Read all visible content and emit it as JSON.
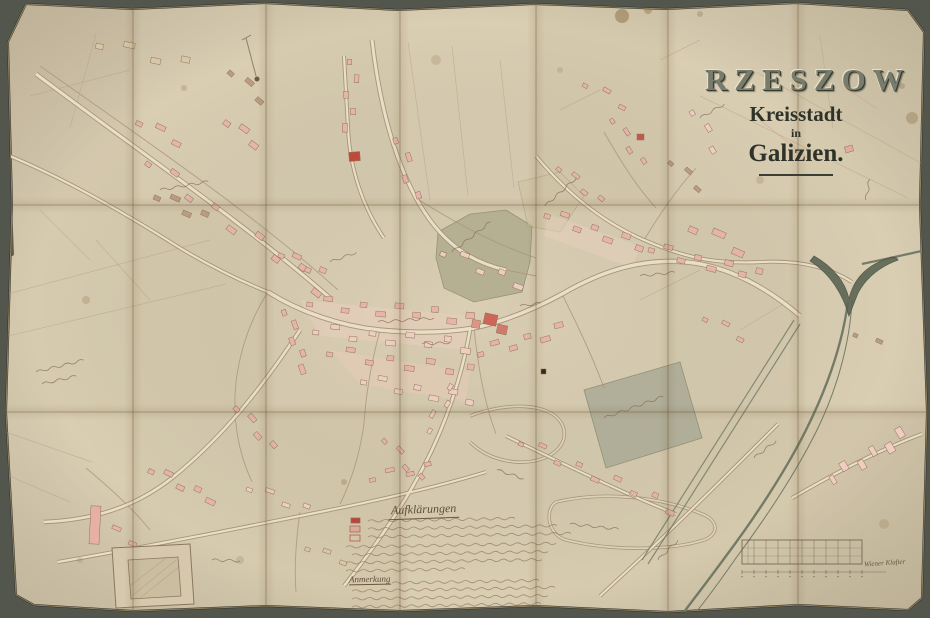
{
  "window": {
    "width": 930,
    "height": 618
  },
  "colors": {
    "backdrop": "#53564c",
    "paper": "#d9cdb2",
    "paper_edge": "#b9a67f",
    "road_casing": "#9f8c72",
    "road_fill": "#e9dfc6",
    "minor_road": "#a7937a",
    "river": "#68725f",
    "river_fork": "#5c6553",
    "building_outline": "#8f7260",
    "handwriting": "#87705f",
    "legend_ink": "#93795f",
    "palette": {
      "pink": "#e7b3a8",
      "lightpink": "#f0cfc2",
      "red": "#c4574a",
      "brown": "#b99a7d",
      "tan": "#d8c8a8"
    }
  },
  "title": {
    "city": "RZESZOW",
    "subtitle1": "Kreisstadt",
    "subtitle2": "in",
    "region": "Galizien."
  },
  "legend": {
    "title": "Aufklärungen",
    "note_title": "Anmerkung",
    "swatches": [
      {
        "x": 351,
        "y": 518,
        "w": 9,
        "h": 5,
        "c": "#b8473a",
        "filled": true
      },
      {
        "x": 350,
        "y": 526,
        "w": 10,
        "h": 6,
        "c": "#e2a79b",
        "filled": true
      },
      {
        "x": 350,
        "y": 535,
        "w": 10,
        "h": 6,
        "c": "#b8473a",
        "filled": false
      }
    ],
    "lines": [
      [
        368,
        521,
        150
      ],
      [
        368,
        529,
        190
      ],
      [
        368,
        537,
        202
      ],
      [
        346,
        547,
        208
      ],
      [
        352,
        555,
        196
      ],
      [
        346,
        563,
        198
      ],
      [
        346,
        571,
        122
      ]
    ],
    "note_lines": [
      [
        392,
        583,
        148
      ],
      [
        352,
        591,
        200
      ],
      [
        352,
        599,
        196
      ],
      [
        352,
        607,
        188
      ],
      [
        360,
        613,
        118
      ]
    ]
  },
  "scale_bar": {
    "x": 742,
    "y": 540,
    "width": 120,
    "height": 24,
    "cols": 10,
    "label": "Wiener Klafter"
  },
  "folds": {
    "vertical": [
      133,
      266,
      400,
      536,
      668,
      798
    ],
    "horizontal": [
      205,
      412
    ]
  },
  "paper_outline": [
    [
      26,
      4
    ],
    [
      132,
      9
    ],
    [
      264,
      3
    ],
    [
      398,
      10
    ],
    [
      534,
      4
    ],
    [
      666,
      9
    ],
    [
      796,
      3
    ],
    [
      908,
      10
    ],
    [
      924,
      32
    ],
    [
      920,
      205
    ],
    [
      927,
      412
    ],
    [
      922,
      598
    ],
    [
      908,
      610
    ],
    [
      798,
      605
    ],
    [
      668,
      612
    ],
    [
      536,
      606
    ],
    [
      400,
      611
    ],
    [
      266,
      606
    ],
    [
      134,
      611
    ],
    [
      34,
      605
    ],
    [
      16,
      595
    ],
    [
      6,
      412
    ],
    [
      12,
      205
    ],
    [
      8,
      42
    ]
  ],
  "panel_tints": [
    [
      0.04,
      0,
      0.02,
      0,
      0.03,
      0,
      0.02
    ],
    [
      0.02,
      0.03,
      0,
      0.02,
      0,
      0.02,
      0
    ],
    [
      0,
      0.02,
      0.03,
      0,
      0.02,
      0.03,
      0.05
    ]
  ],
  "map": {
    "areas": [
      {
        "pts": "438,232 470,214 506,210 532,226 530,262 522,292 474,302 444,288 436,258",
        "f": "#b1ac8e",
        "o": 0.85,
        "s": "#8d8a70"
      },
      {
        "pts": "584,390 680,362 702,438 606,468",
        "f": "#a9a995",
        "o": 0.8,
        "s": "#84836c"
      },
      {
        "pts": "518,182 560,172 584,196 560,232 528,226",
        "f": "#cfc3a2",
        "o": 0.55,
        "s": "#a89a7c"
      }
    ],
    "block_washes": [
      {
        "pts": "300,300 470,316 466,350 320,336",
        "f": "#eccfbe",
        "o": 0.5
      },
      {
        "pts": "330,350 470,372 466,402 360,384",
        "f": "#eac9b8",
        "o": 0.45
      },
      {
        "pts": "548,214 640,246 632,268 544,236",
        "f": "#ecd2c2",
        "o": 0.4
      }
    ],
    "field_lines": [
      [
        756,
        72,
        930,
        168
      ],
      [
        700,
        96,
        908,
        198
      ],
      [
        820,
        36,
        833,
        128
      ],
      [
        408,
        42,
        430,
        200
      ],
      [
        452,
        46,
        468,
        196
      ],
      [
        500,
        60,
        514,
        188
      ],
      [
        0,
        296,
        210,
        240
      ],
      [
        0,
        338,
        226,
        284
      ],
      [
        30,
        96,
        130,
        70
      ],
      [
        96,
        34,
        70,
        128
      ],
      [
        0,
        430,
        92,
        462
      ],
      [
        0,
        472,
        70,
        502
      ],
      [
        560,
        110,
        600,
        90
      ],
      [
        660,
        60,
        700,
        40
      ],
      [
        740,
        330,
        790,
        300
      ],
      [
        640,
        300,
        700,
        270
      ],
      [
        96,
        240,
        150,
        300
      ],
      [
        40,
        210,
        90,
        260
      ]
    ],
    "pink_lines": [
      [
        846,
        88,
        876,
        108
      ],
      [
        760,
        120,
        810,
        160
      ]
    ],
    "roads": [
      {
        "d": "M36,74 C140,152 248,226 330,298",
        "w": 3
      },
      {
        "d": "M268,292 C300,312 340,326 380,330 C420,334 450,332 474,328",
        "w": 3.5
      },
      {
        "d": "M474,328 C510,320 540,306 562,294 C600,272 640,258 686,262 C730,266 770,290 800,316",
        "w": 3.5
      },
      {
        "d": "M372,40 C378,92 390,150 416,198 C440,242 470,262 506,270",
        "w": 3
      },
      {
        "d": "M344,56 L348,128 C350,168 362,206 384,238",
        "w": 2.2
      },
      {
        "d": "M536,156 C566,192 602,222 644,240 C690,260 720,264 762,262 C800,260 830,268 852,282",
        "w": 2.2
      },
      {
        "d": "M470,330 C462,376 446,424 424,466 C402,508 374,548 344,586",
        "w": 2.6
      },
      {
        "d": "M300,330 C262,388 222,438 172,478 C134,508 92,520 44,522",
        "w": 2.6
      },
      {
        "d": "M58,562 C150,546 240,528 320,512 C390,498 440,486 486,472",
        "w": 2.2
      },
      {
        "d": "M506,436 C560,462 620,492 676,514",
        "w": 2
      },
      {
        "d": "M792,498 C840,470 884,448 922,434",
        "w": 2.2
      },
      {
        "d": "M778,424 C732,470 680,522 628,570 L600,596",
        "w": 2
      },
      {
        "d": "M0,152 C60,176 120,210 180,248 C220,272 248,284 268,292",
        "w": 2.2
      }
    ],
    "minor_roads": [
      "M416,198 C460,226 500,246 536,258",
      "M268,292 C250,320 240,350 236,382",
      "M236,382 C232,420 238,452 252,482",
      "M380,330 C372,360 366,392 364,424",
      "M364,424 C360,452 352,480 340,504",
      "M474,328 C478,366 484,402 496,434",
      "M562,294 C580,330 594,360 604,388",
      "M644,240 C660,214 676,190 696,168",
      "M604,132 C620,160 636,186 656,208",
      "M86,468 C110,488 134,510 150,530",
      "M300,512 C296,540 294,566 296,592",
      "M40,66 C148,142 256,216 338,290",
      "M140,546 C146,566 150,586 152,604",
      "M506,270 C516,272 526,274 536,276"
    ],
    "rivers": [
      {
        "d": "M926,250 C900,256 880,260 862,264",
        "w": 2.2
      },
      {
        "d": "M848,302 C842,346 826,390 806,430 C786,470 756,516 726,556 C710,578 696,596 684,612",
        "w": 2.4
      },
      {
        "d": "M852,300 C850,344 836,392 816,432 C796,472 766,518 736,558 C722,578 708,598 696,612",
        "w": 1
      }
    ],
    "fork": "M814,256 C833,267 845,281 849,299 C853,281 864,267 886,259 C893,256 897,257 898,260 C879,267 866,278 858,293 L849,316 C843,295 831,274 810,261 Z",
    "channels": [
      "M794,320 L642,560",
      "M800,324 L648,564"
    ],
    "meanders": [
      "M470,416 C506,402 550,402 562,424 C572,446 548,464 516,462 C492,460 478,450 470,442",
      "M556,502 C606,490 664,498 702,514 C718,520 720,534 704,540 C666,552 606,550 566,540 C548,535 544,510 556,502"
    ],
    "building_rows": [
      {
        "x1": 100,
        "y1": 44,
        "x2": 185,
        "y2": 62,
        "n": 4,
        "w": 10,
        "h": 7,
        "c": "tan",
        "s": 5
      },
      {
        "x1": 232,
        "y1": 72,
        "x2": 262,
        "y2": 98,
        "n": 3,
        "w": 8,
        "h": 6,
        "c": "brown",
        "s": 4
      },
      {
        "x1": 140,
        "y1": 122,
        "x2": 178,
        "y2": 140,
        "n": 3,
        "w": 9,
        "h": 6,
        "c": "pink",
        "s": 4
      },
      {
        "x1": 158,
        "y1": 196,
        "x2": 204,
        "y2": 216,
        "n": 4,
        "w": 9,
        "h": 6,
        "c": "brown",
        "s": 5
      },
      {
        "x1": 228,
        "y1": 122,
        "x2": 256,
        "y2": 142,
        "n": 3,
        "w": 9,
        "h": 7,
        "c": "pink",
        "s": 4
      },
      {
        "x1": 282,
        "y1": 254,
        "x2": 322,
        "y2": 272,
        "n": 4,
        "w": 8,
        "h": 6,
        "c": "pink",
        "s": 4
      },
      {
        "x1": 150,
        "y1": 162,
        "x2": 320,
        "y2": 288,
        "n": 9,
        "w": 8,
        "h": 6,
        "c": "pink",
        "s": 6
      },
      {
        "x1": 352,
        "y1": 62,
        "x2": 350,
        "y2": 128,
        "n": 5,
        "w": 7,
        "h": 6,
        "c": "pink",
        "s": 5
      },
      {
        "x1": 398,
        "y1": 140,
        "x2": 416,
        "y2": 196,
        "n": 4,
        "w": 8,
        "h": 6,
        "c": "pink",
        "s": 5
      },
      {
        "x1": 310,
        "y1": 302,
        "x2": 470,
        "y2": 318,
        "n": 10,
        "w": 8,
        "h": 6,
        "c": "pink",
        "s": 5
      },
      {
        "x1": 316,
        "y1": 330,
        "x2": 466,
        "y2": 346,
        "n": 9,
        "w": 8,
        "h": 6,
        "c": "lightpink",
        "s": 5
      },
      {
        "x1": 330,
        "y1": 352,
        "x2": 470,
        "y2": 372,
        "n": 8,
        "w": 8,
        "h": 6,
        "c": "pink",
        "s": 5
      },
      {
        "x1": 286,
        "y1": 312,
        "x2": 306,
        "y2": 368,
        "n": 5,
        "w": 8,
        "h": 6,
        "c": "pink",
        "s": 4
      },
      {
        "x1": 364,
        "y1": 380,
        "x2": 470,
        "y2": 400,
        "n": 7,
        "w": 8,
        "h": 6,
        "c": "lightpink",
        "s": 5
      },
      {
        "x1": 480,
        "y1": 352,
        "x2": 560,
        "y2": 330,
        "n": 6,
        "w": 8,
        "h": 6,
        "c": "pink",
        "s": 5
      },
      {
        "x1": 548,
        "y1": 214,
        "x2": 640,
        "y2": 246,
        "n": 7,
        "w": 8,
        "h": 6,
        "c": "pink",
        "s": 5
      },
      {
        "x1": 652,
        "y1": 248,
        "x2": 758,
        "y2": 276,
        "n": 8,
        "w": 8,
        "h": 6,
        "c": "pink",
        "s": 5
      },
      {
        "x1": 560,
        "y1": 168,
        "x2": 600,
        "y2": 200,
        "n": 4,
        "w": 7,
        "h": 5,
        "c": "pink",
        "s": 4
      },
      {
        "x1": 614,
        "y1": 120,
        "x2": 642,
        "y2": 162,
        "n": 4,
        "w": 7,
        "h": 5,
        "c": "pink",
        "s": 4
      },
      {
        "x1": 672,
        "y1": 162,
        "x2": 700,
        "y2": 186,
        "n": 3,
        "w": 7,
        "h": 5,
        "c": "brown",
        "s": 4
      },
      {
        "x1": 832,
        "y1": 478,
        "x2": 902,
        "y2": 436,
        "n": 6,
        "w": 6,
        "h": 12,
        "c": "lightpink",
        "s": 4
      },
      {
        "x1": 522,
        "y1": 442,
        "x2": 672,
        "y2": 508,
        "n": 9,
        "w": 7,
        "h": 5,
        "c": "pink",
        "s": 5
      },
      {
        "x1": 428,
        "y1": 430,
        "x2": 452,
        "y2": 388,
        "n": 4,
        "w": 7,
        "h": 5,
        "c": "lightpink",
        "s": 4
      },
      {
        "x1": 386,
        "y1": 440,
        "x2": 420,
        "y2": 478,
        "n": 4,
        "w": 7,
        "h": 5,
        "c": "pink",
        "s": 4
      },
      {
        "x1": 238,
        "y1": 408,
        "x2": 272,
        "y2": 446,
        "n": 4,
        "w": 8,
        "h": 6,
        "c": "pink",
        "s": 4
      },
      {
        "x1": 152,
        "y1": 470,
        "x2": 212,
        "y2": 498,
        "n": 5,
        "w": 8,
        "h": 6,
        "c": "pink",
        "s": 4
      },
      {
        "x1": 96,
        "y1": 524,
        "x2": 134,
        "y2": 540,
        "n": 3,
        "w": 8,
        "h": 5,
        "c": "pink",
        "s": 4
      },
      {
        "x1": 250,
        "y1": 488,
        "x2": 306,
        "y2": 508,
        "n": 4,
        "w": 8,
        "h": 5,
        "c": "lightpink",
        "s": 4
      },
      {
        "x1": 372,
        "y1": 478,
        "x2": 428,
        "y2": 466,
        "n": 4,
        "w": 8,
        "h": 5,
        "c": "pink",
        "s": 4
      },
      {
        "x1": 586,
        "y1": 84,
        "x2": 624,
        "y2": 104,
        "n": 3,
        "w": 7,
        "h": 5,
        "c": "pink",
        "s": 4
      },
      {
        "x1": 706,
        "y1": 318,
        "x2": 742,
        "y2": 336,
        "n": 3,
        "w": 7,
        "h": 5,
        "c": "pink",
        "s": 4
      },
      {
        "x1": 694,
        "y1": 112,
        "x2": 716,
        "y2": 148,
        "n": 3,
        "w": 7,
        "h": 6,
        "c": "lightpink",
        "s": 4
      },
      {
        "x1": 856,
        "y1": 334,
        "x2": 878,
        "y2": 344,
        "n": 2,
        "w": 6,
        "h": 5,
        "c": "brown",
        "s": 3
      },
      {
        "x1": 694,
        "y1": 228,
        "x2": 740,
        "y2": 248,
        "n": 3,
        "w": 12,
        "h": 8,
        "c": "pink",
        "s": 5
      },
      {
        "x1": 308,
        "y1": 548,
        "x2": 344,
        "y2": 560,
        "n": 3,
        "w": 7,
        "h": 5,
        "c": "tan",
        "s": 3
      },
      {
        "x1": 444,
        "y1": 252,
        "x2": 520,
        "y2": 282,
        "n": 5,
        "w": 8,
        "h": 6,
        "c": "lightpink",
        "s": 5
      }
    ],
    "special_buildings": [
      {
        "x": 484,
        "y": 314,
        "w": 13,
        "h": 11,
        "r": 12,
        "c": "#cf6557"
      },
      {
        "x": 497,
        "y": 325,
        "w": 10,
        "h": 9,
        "r": 12,
        "c": "#d07a6c"
      },
      {
        "x": 472,
        "y": 320,
        "w": 8,
        "h": 8,
        "r": 8,
        "c": "#df9488"
      },
      {
        "x": 349,
        "y": 152,
        "w": 11,
        "h": 9,
        "r": -5,
        "c": "#bf4a3c"
      },
      {
        "x": 637,
        "y": 134,
        "w": 7,
        "h": 6,
        "r": 0,
        "c": "#c3584a"
      },
      {
        "x": 541,
        "y": 369,
        "w": 5,
        "h": 5,
        "r": 0,
        "c": "#2e2a24"
      },
      {
        "x": 845,
        "y": 146,
        "w": 8,
        "h": 6,
        "r": -15,
        "c": "#e4aa9e"
      },
      {
        "x": 90,
        "y": 506,
        "w": 10,
        "h": 38,
        "r": 3,
        "c": "#e6b0a4"
      }
    ],
    "enclosure": {
      "outer": "M112,548 L190,544 L194,604 L116,608 Z",
      "inner": "M128,560 L178,557 L181,596 L131,599 Z",
      "hatch": [
        [
          132,
          596,
          176,
          560
        ],
        [
          140,
          598,
          180,
          566
        ],
        [
          130,
          586,
          166,
          558
        ]
      ]
    },
    "avenue": {
      "line": [
        246,
        38,
        256,
        76
      ],
      "tick": [
        242,
        40,
        251,
        35
      ],
      "dot": [
        257,
        79,
        2.5
      ]
    },
    "labels": [
      [
        160,
        190,
        -10,
        46
      ],
      [
        36,
        372,
        -14,
        48
      ],
      [
        42,
        384,
        -13,
        36
      ],
      [
        452,
        252,
        -38,
        46
      ],
      [
        545,
        206,
        -42,
        40
      ],
      [
        604,
        418,
        -20,
        64
      ],
      [
        378,
        322,
        -4,
        56
      ],
      [
        497,
        470,
        18,
        30
      ],
      [
        570,
        524,
        6,
        48
      ],
      [
        754,
        458,
        -38,
        30
      ],
      [
        640,
        276,
        -6,
        34
      ],
      [
        700,
        118,
        -30,
        30
      ],
      [
        212,
        560,
        2,
        30
      ],
      [
        658,
        560,
        -45,
        26
      ],
      [
        422,
        344,
        -3,
        30
      ],
      [
        330,
        262,
        -20,
        28
      ],
      [
        520,
        306,
        -8,
        24
      ],
      [
        866,
        200,
        -80,
        24
      ]
    ],
    "stains": [
      [
        622,
        16,
        7,
        0.5
      ],
      [
        648,
        10,
        4,
        0.4
      ],
      [
        700,
        14,
        3,
        0.3
      ],
      [
        912,
        118,
        6,
        0.35
      ],
      [
        902,
        86,
        3,
        0.3
      ],
      [
        86,
        300,
        4,
        0.25
      ],
      [
        344,
        482,
        3,
        0.3
      ],
      [
        436,
        60,
        5,
        0.2
      ],
      [
        884,
        524,
        5,
        0.2
      ],
      [
        184,
        88,
        3,
        0.25
      ],
      [
        760,
        180,
        4,
        0.2
      ],
      [
        560,
        70,
        3,
        0.2
      ],
      [
        240,
        560,
        4,
        0.2
      ],
      [
        80,
        560,
        3,
        0.2
      ]
    ],
    "torn_patch": "M0,200 L12,205 L14,255 L2,262 Z"
  }
}
